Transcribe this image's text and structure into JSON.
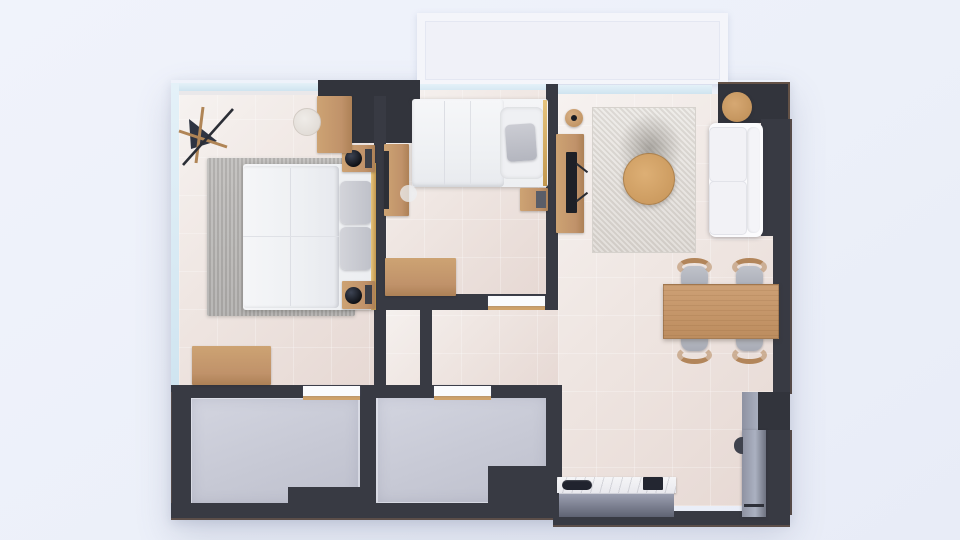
{
  "scene": {
    "title": "apartment-floor-plan-top-view-render",
    "rooms": [
      {
        "name": "bedroom-1",
        "furniture": [
          "double-bed",
          "gray-area-rug",
          "bedside-shelf-with-lamp",
          "bedside-shelf-with-lamp",
          "butterfly-chair",
          "round-stool",
          "tall-desk-cabinet",
          "low-dresser"
        ]
      },
      {
        "name": "bedroom-2",
        "furniture": [
          "double-bed",
          "wardrobe",
          "nightstand",
          "desk"
        ]
      },
      {
        "name": "living-dining-room",
        "furniture": [
          "white-sofa",
          "round-coffee-table",
          "round-side-table",
          "mottled-area-rug",
          "tv-console",
          "tv",
          "round-vase",
          "dining-table",
          "dining-chair",
          "dining-chair",
          "dining-chair",
          "dining-chair"
        ]
      },
      {
        "name": "kitchen",
        "furniture": [
          "counter-with-sink-and-cooktop",
          "refrigerator"
        ]
      },
      {
        "name": "bathroom-1",
        "furniture": []
      },
      {
        "name": "bathroom-2",
        "furniture": []
      },
      {
        "name": "balcony",
        "furniture": []
      }
    ],
    "doors": [
      "bedroom1-to-bathroom1",
      "hall-to-bathroom2",
      "bedroom2-to-hall"
    ]
  },
  "colors": {
    "page-bg": "#edf1f9",
    "wall": "#383a43",
    "wall-dark": "#32343c",
    "floor-light": "#f5f0ee",
    "floor-warm": "#e8dcd7",
    "bath-floor": "#c9cbd6",
    "glass": "#d9e9f3",
    "wood": "#c0926a",
    "wood-light": "#cda373",
    "gold": "#d8b269",
    "linen": "#f1f2f5",
    "pillow-gray": "#c3c5cd",
    "rug-gray": "#b8b6b4",
    "rug-living": "#e5e2de",
    "sofa-white": "#fbfbfd",
    "counter-gray": "#82869a",
    "marble": "#f1f1f4",
    "appliance-dark": "#20232c",
    "door-white": "#fafbfd",
    "threshold-tan": "#cfa26b",
    "seat-gray": "#b4b7c0",
    "balcony-white": "#f4f5fa"
  }
}
